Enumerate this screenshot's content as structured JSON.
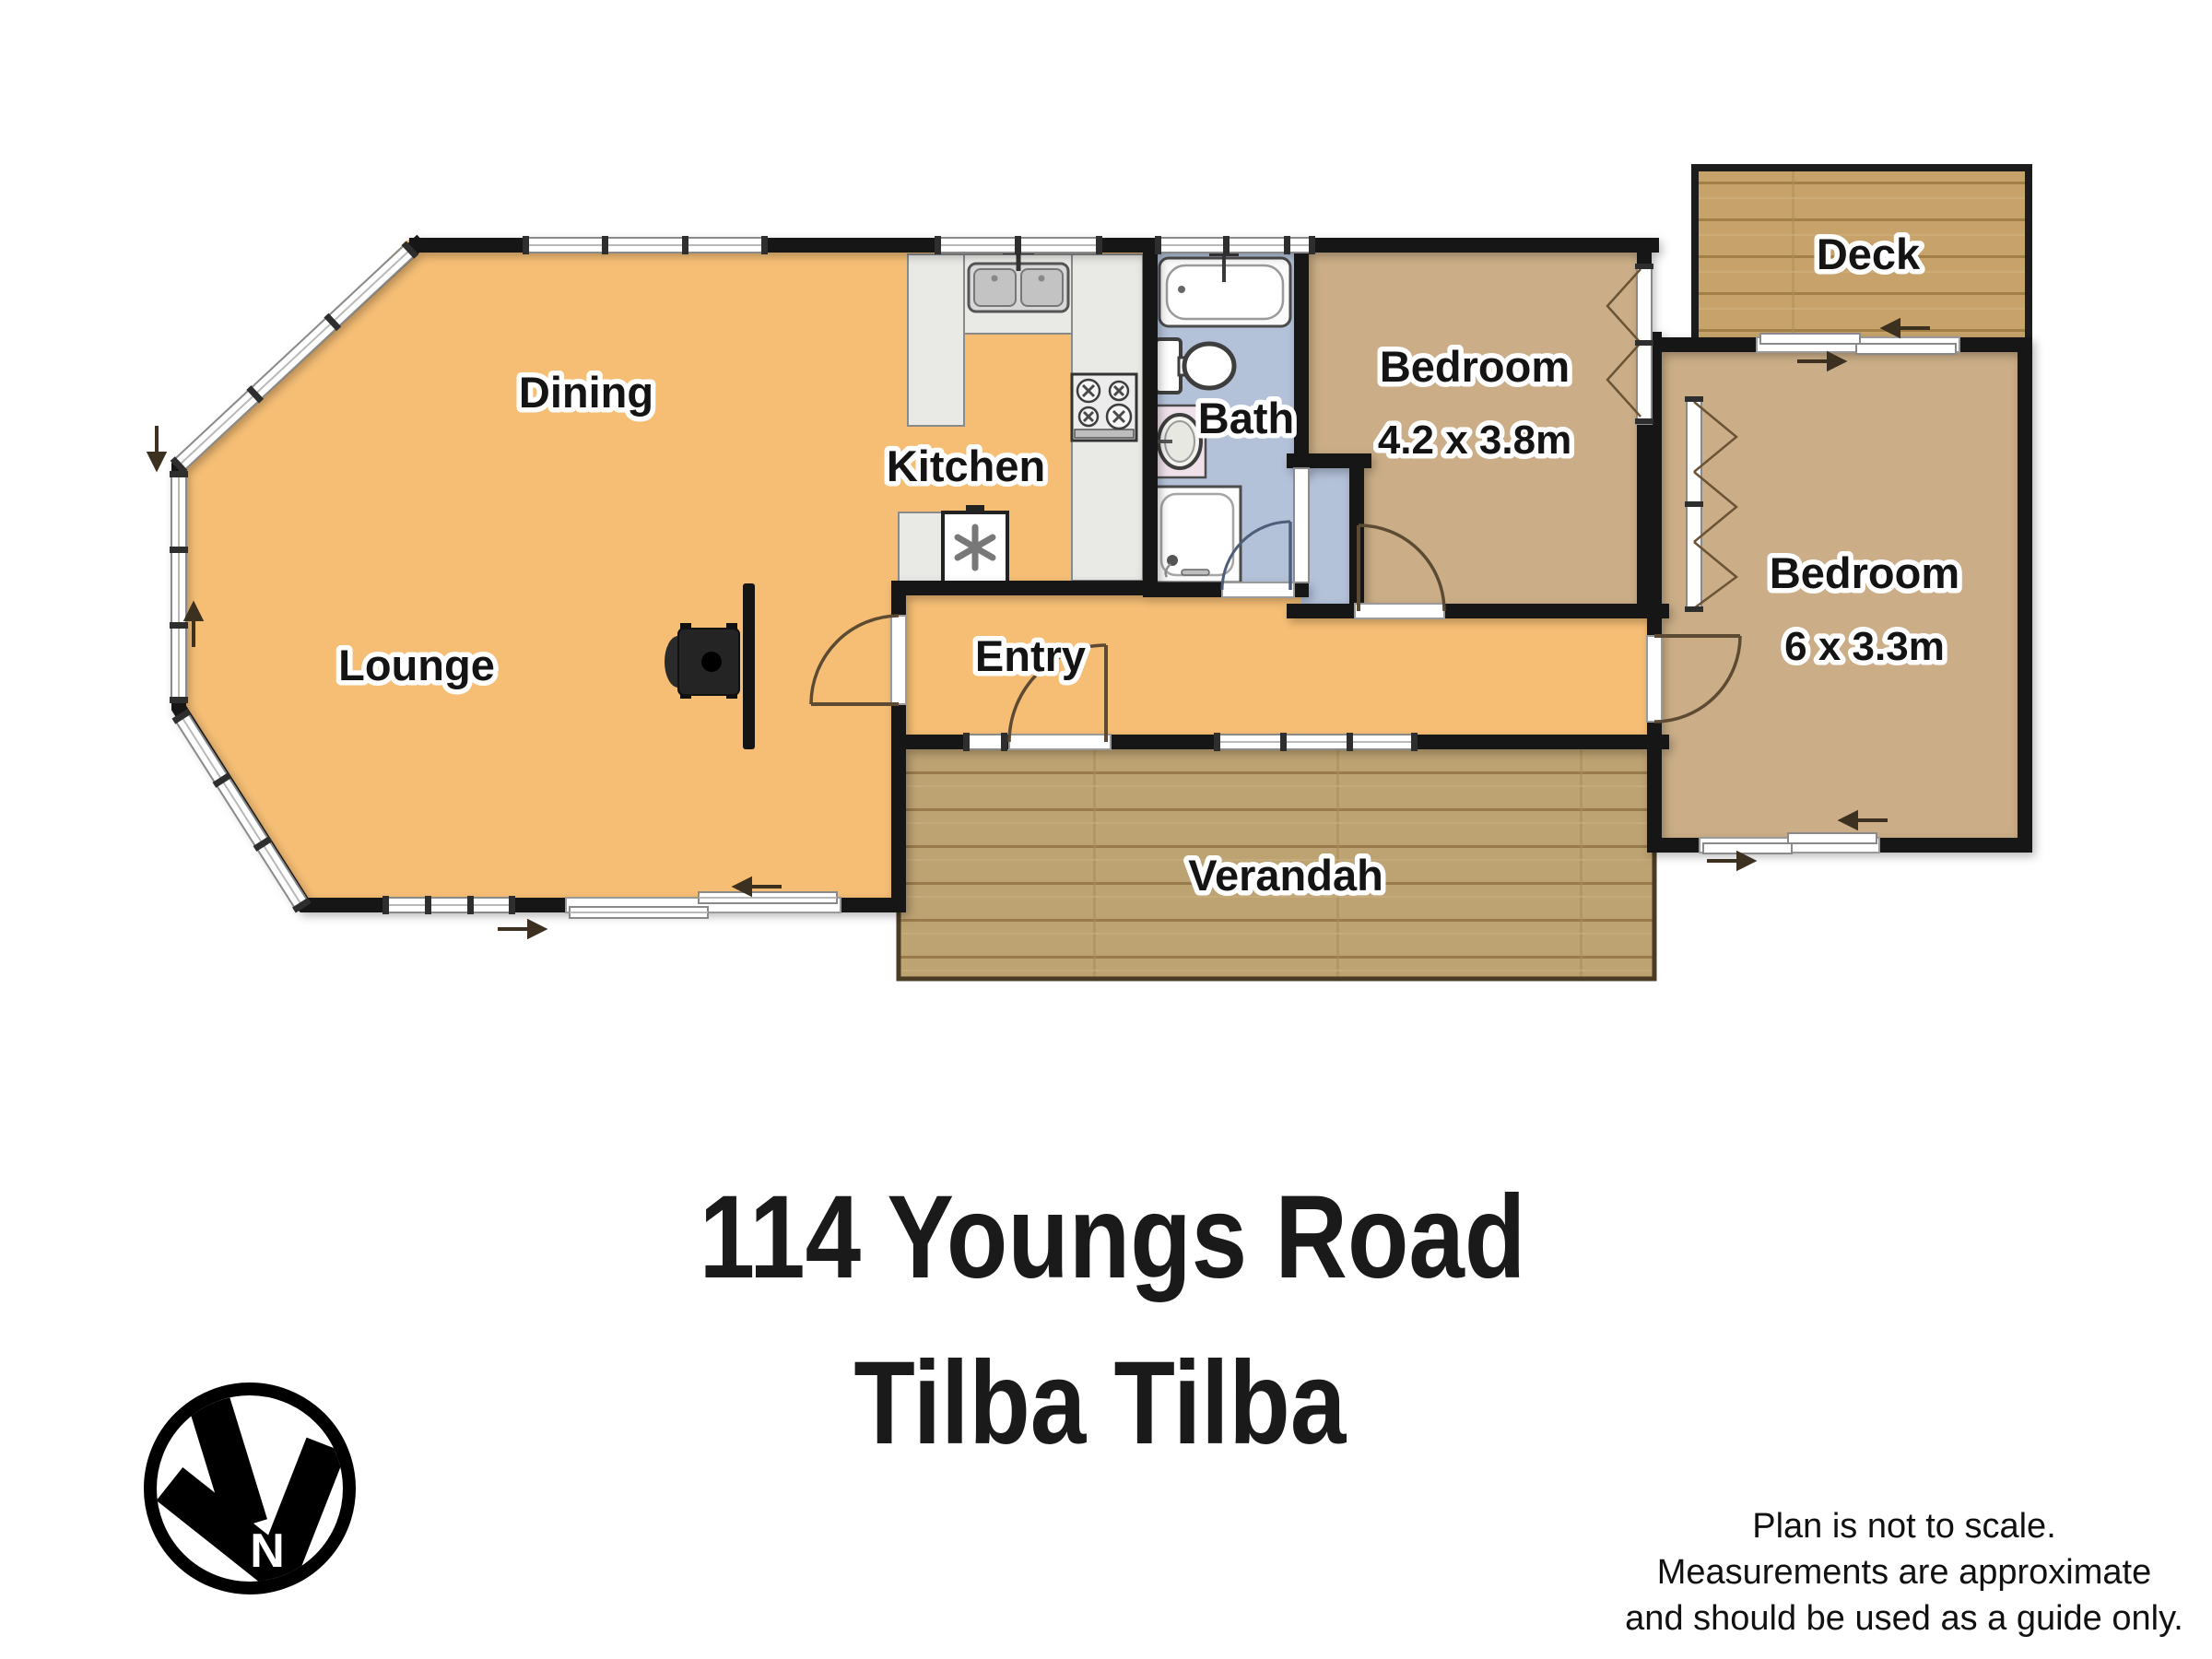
{
  "rooms": {
    "dining": {
      "label": "Dining"
    },
    "lounge": {
      "label": "Lounge"
    },
    "kitchen": {
      "label": "Kitchen"
    },
    "bath": {
      "label": "Bath"
    },
    "entry": {
      "label": "Entry"
    },
    "verandah": {
      "label": "Verandah"
    },
    "bedroom1": {
      "label": "Bedroom",
      "dimensions": "4.2 x 3.8m"
    },
    "bedroom2": {
      "label": "Bedroom",
      "dimensions": "6 x 3.3m"
    },
    "deck": {
      "label": "Deck"
    }
  },
  "title": {
    "line1": "114 Youngs Road",
    "line2": "Tilba Tilba"
  },
  "compass": {
    "north_label": "N"
  },
  "disclaimer": {
    "line1": "Plan is not to scale.",
    "line2": "Measurements are approximate",
    "line3": "and should be used as a guide only."
  },
  "colors": {
    "living_floor": "#F6BE75",
    "bedroom_floor": "#CBAE87",
    "bath_floor": "#B3C1D9",
    "verandah_wood": "#BDA272",
    "deck_wood": "#C7A36B",
    "wall": "#141414"
  }
}
